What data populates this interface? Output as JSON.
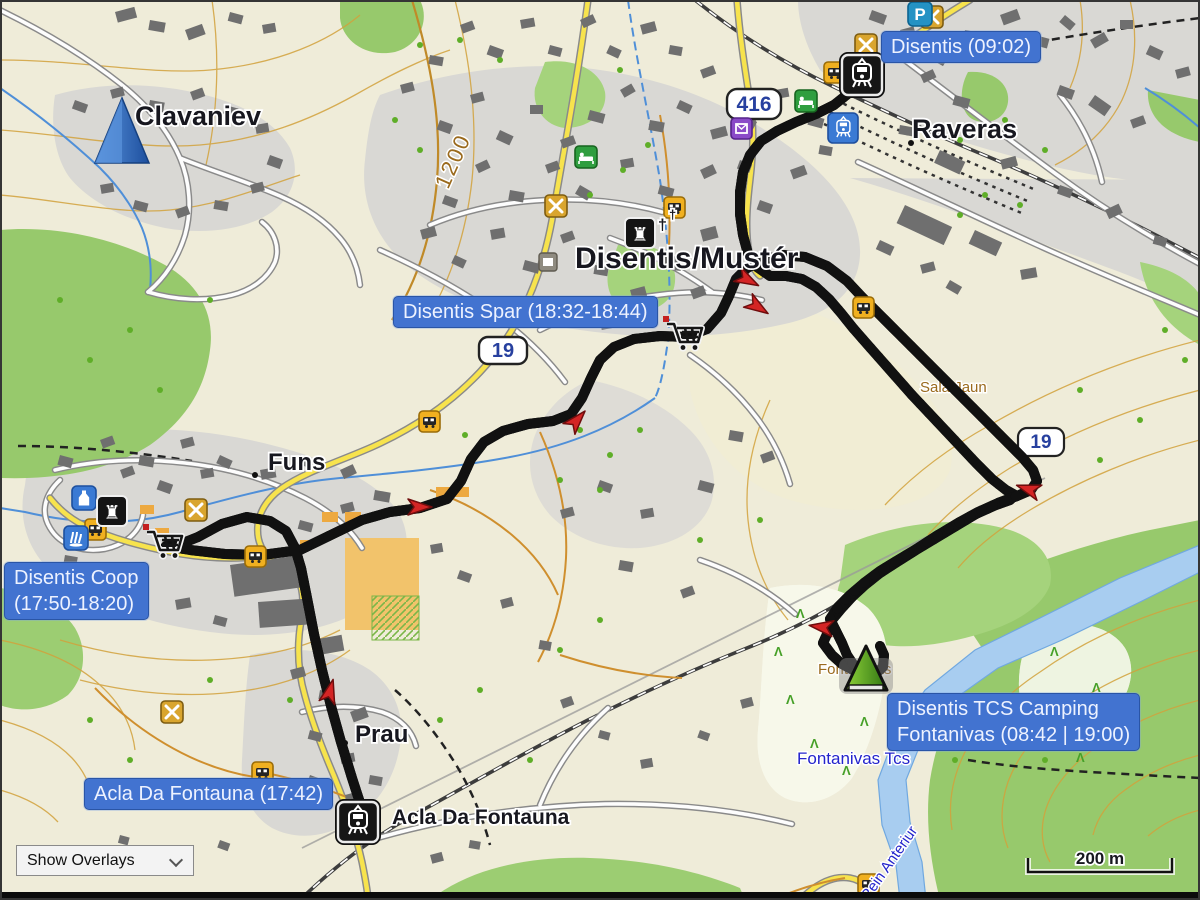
{
  "ui": {
    "overlays_dropdown": {
      "value": "Show Overlays"
    },
    "scale_bar_label": "200 m"
  },
  "waypoints": {
    "disentis": {
      "label": "Disentis (09:02)"
    },
    "spar": {
      "label": "Disentis Spar (18:32-18:44)"
    },
    "coop": {
      "line1": "Disentis Coop",
      "line2": "(17:50-18:20)"
    },
    "acla": {
      "label": "Acla Da Fontauna (17:42)"
    },
    "camping": {
      "line1": "Disentis TCS Camping",
      "line2": "Fontanivas (08:42 | 19:00)"
    }
  },
  "map_labels": {
    "clavaniev": "Clavaniev",
    "raveras": "Raveras",
    "disentis_muster": "Disentis/Mustér",
    "funs": "Funs",
    "prau": "Prau",
    "acla_da_fontauna": "Acla Da Fontauna",
    "fontanivas_tcs": "Fontanivas Tcs",
    "fontanivas_area": "Fontanivas",
    "rein_anteriur": "Rein Anteriur",
    "sala_jaun": "Sala Jaun",
    "contour_1200": "1200"
  },
  "road_shields": {
    "route_416": "416",
    "route_19": "19"
  },
  "glyphs": {
    "monument": "♜",
    "cross": "†",
    "parking": "P",
    "tent": "Λ"
  },
  "tracks": {
    "evening": {
      "color": "#00dce8"
    },
    "morning": {
      "color": "#f2df00"
    }
  }
}
